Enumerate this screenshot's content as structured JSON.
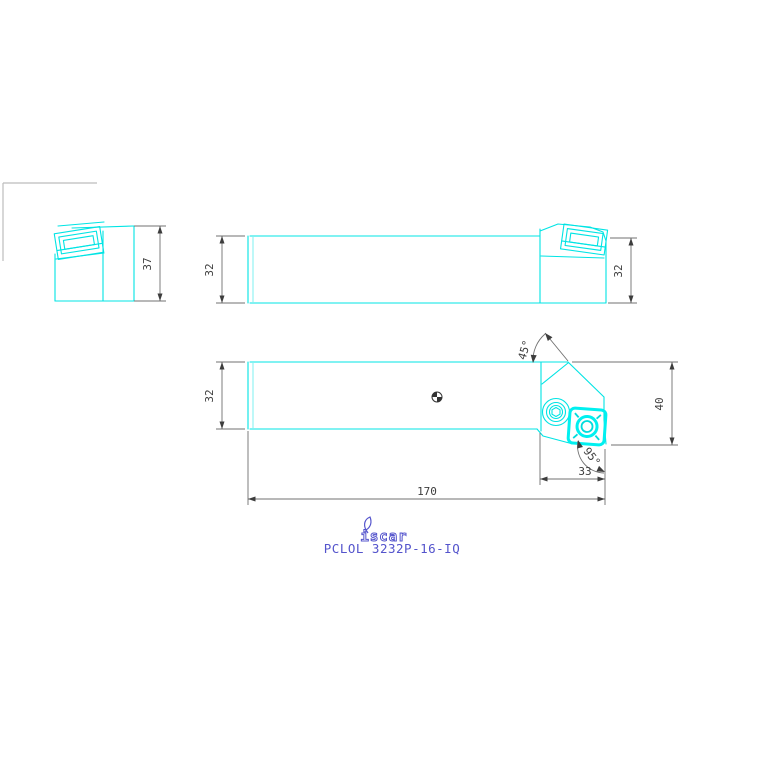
{
  "drawing": {
    "brand_logo": "iscar",
    "part_number": "PCLOL 3232P-16-IQ",
    "dimensions": {
      "end_view_height": "37",
      "top_view_width_left": "32",
      "top_view_width_right": "32",
      "front_view_shank_height": "32",
      "front_view_head_height": "40",
      "head_length": "33",
      "overall_length": "170",
      "chamfer_angle": "45°",
      "cutting_edge_angle": "95°"
    },
    "colors": {
      "geometry_cyan": "#00e4e4",
      "insert_highlight_cyan": "#00f0f0",
      "dimension_gray": "#3d3d3d",
      "dim_line_gray": "#707070",
      "brand_blue": "#5454cc",
      "frame_gray": "#bcbcbc",
      "background": "#ffffff"
    }
  }
}
